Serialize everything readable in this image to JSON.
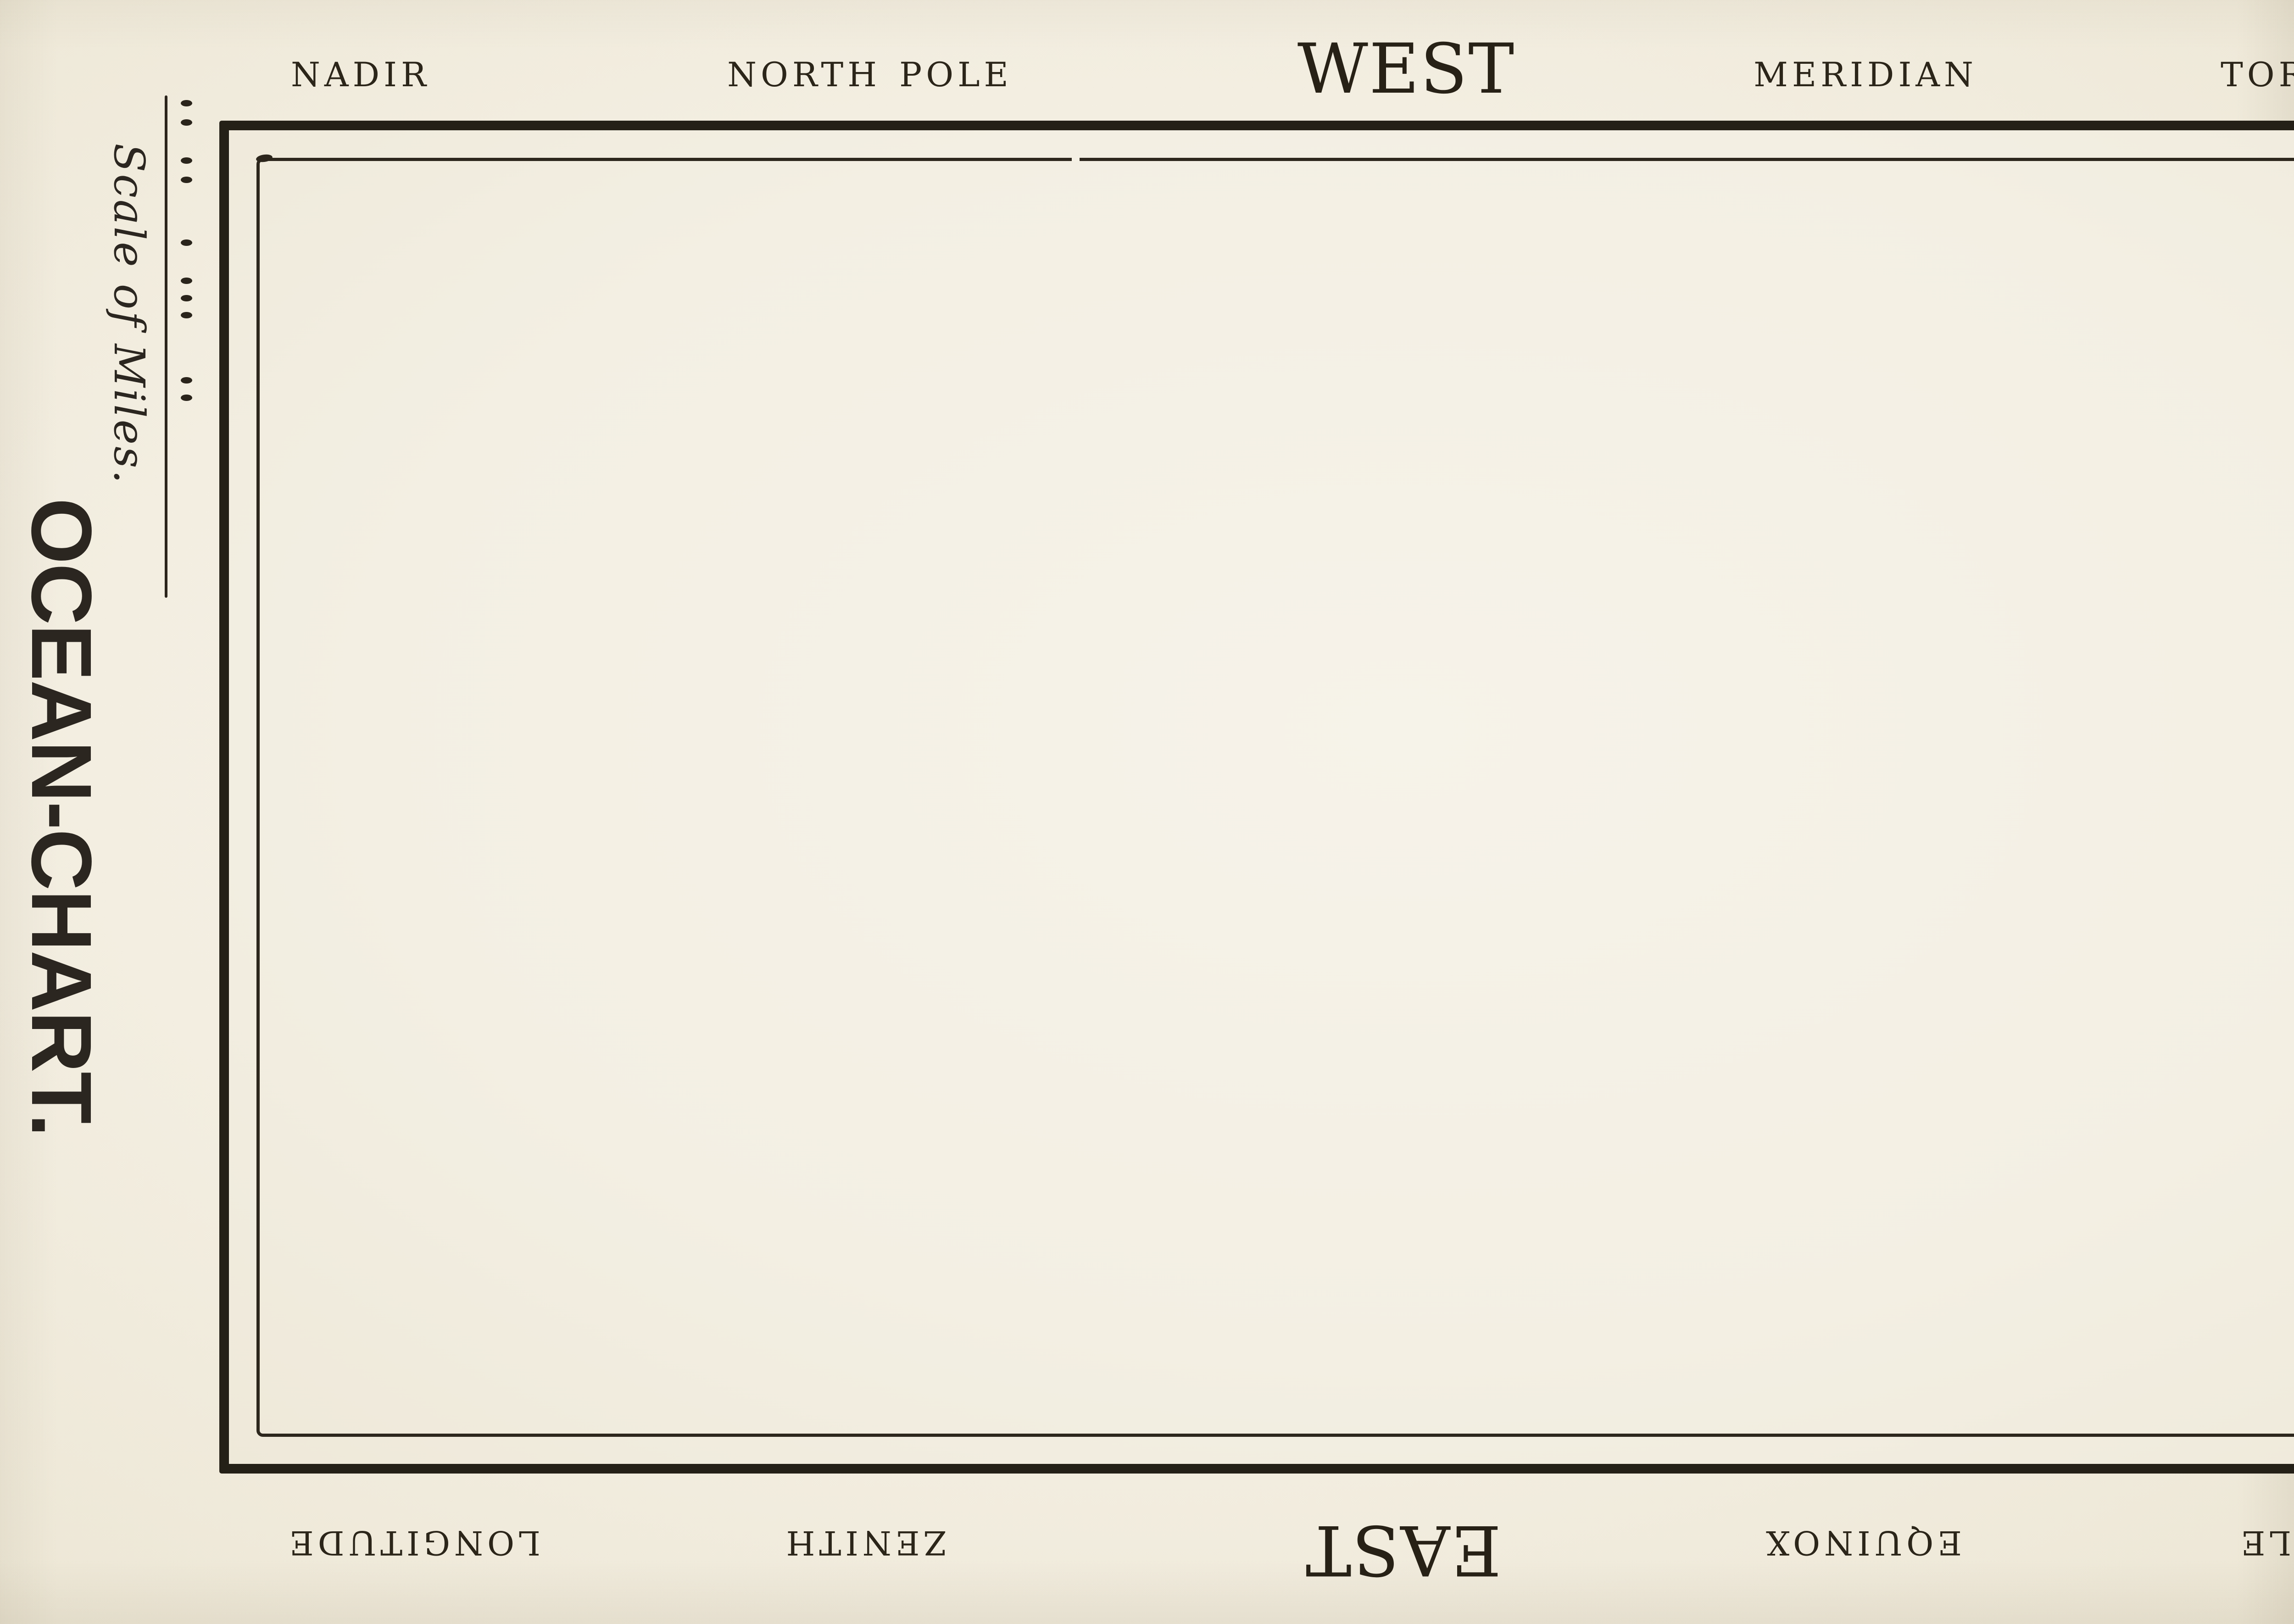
{
  "artwork": {
    "left_margin": {
      "title": "OCEAN-CHART.",
      "scale_caption": "Scale of Miles.",
      "scale_dot_y_centers": [
        225,
        267,
        350,
        392,
        529,
        612,
        650,
        687,
        829,
        867
      ]
    },
    "border_labels": {
      "top": [
        "NADIR",
        "NORTH POLE",
        "WEST",
        "MERIDIAN",
        "TORRID ZONE"
      ],
      "bottom": [
        "LONGITUDE",
        "ZENITH",
        "EAST",
        "EQUINOX",
        "SOUTH POLE"
      ],
      "right": [
        "LATITUDE",
        "NORTH",
        "EQUATOR"
      ]
    },
    "colors": {
      "paper": "#f3eee1",
      "paper_edge": "#ece6d4",
      "ink": "#262017"
    }
  }
}
